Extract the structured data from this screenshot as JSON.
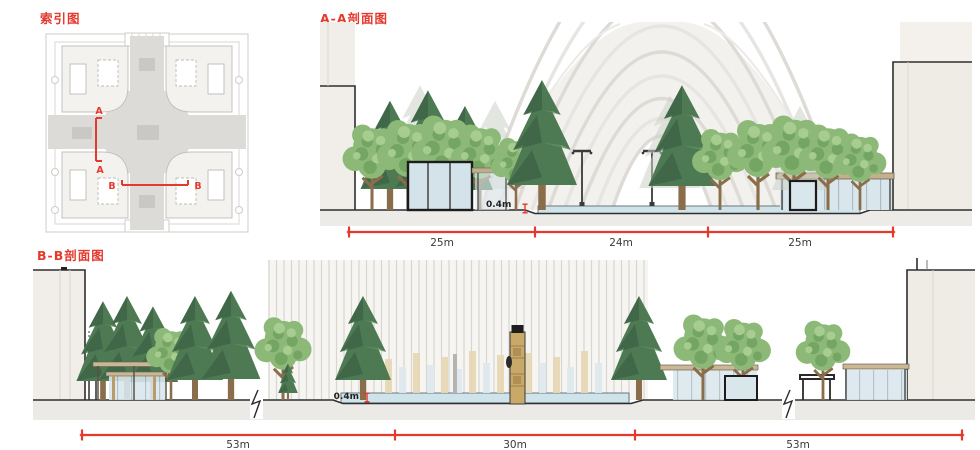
{
  "titles": {
    "index": "索引图",
    "section_aa": "A-A剖面图",
    "section_bb": "B-B剖面图"
  },
  "index_map": {
    "section_a_label_top": "A",
    "section_a_label_bottom": "A",
    "section_b_label_left": "B",
    "section_b_label_right": "B"
  },
  "section_aa": {
    "depth_label": "0.4m",
    "dimensions": [
      "25m",
      "24m",
      "25m"
    ]
  },
  "section_bb": {
    "depth_label": "0.4m",
    "dimensions": [
      "53m",
      "30m",
      "53m"
    ]
  },
  "colors": {
    "accent_red": "#e5382e",
    "conifer_green": "#4d7a53",
    "broadleaf_green": "#8cb977",
    "glass_blue": "#d9e6ec",
    "water_blue": "#cfe4ea",
    "wood_tan": "#c9b795",
    "totem_tan": "#c9a968",
    "building_fill": "#f1eee9",
    "plaza_gray": "#dcdbd8",
    "line_dark": "#2e2e2e"
  }
}
